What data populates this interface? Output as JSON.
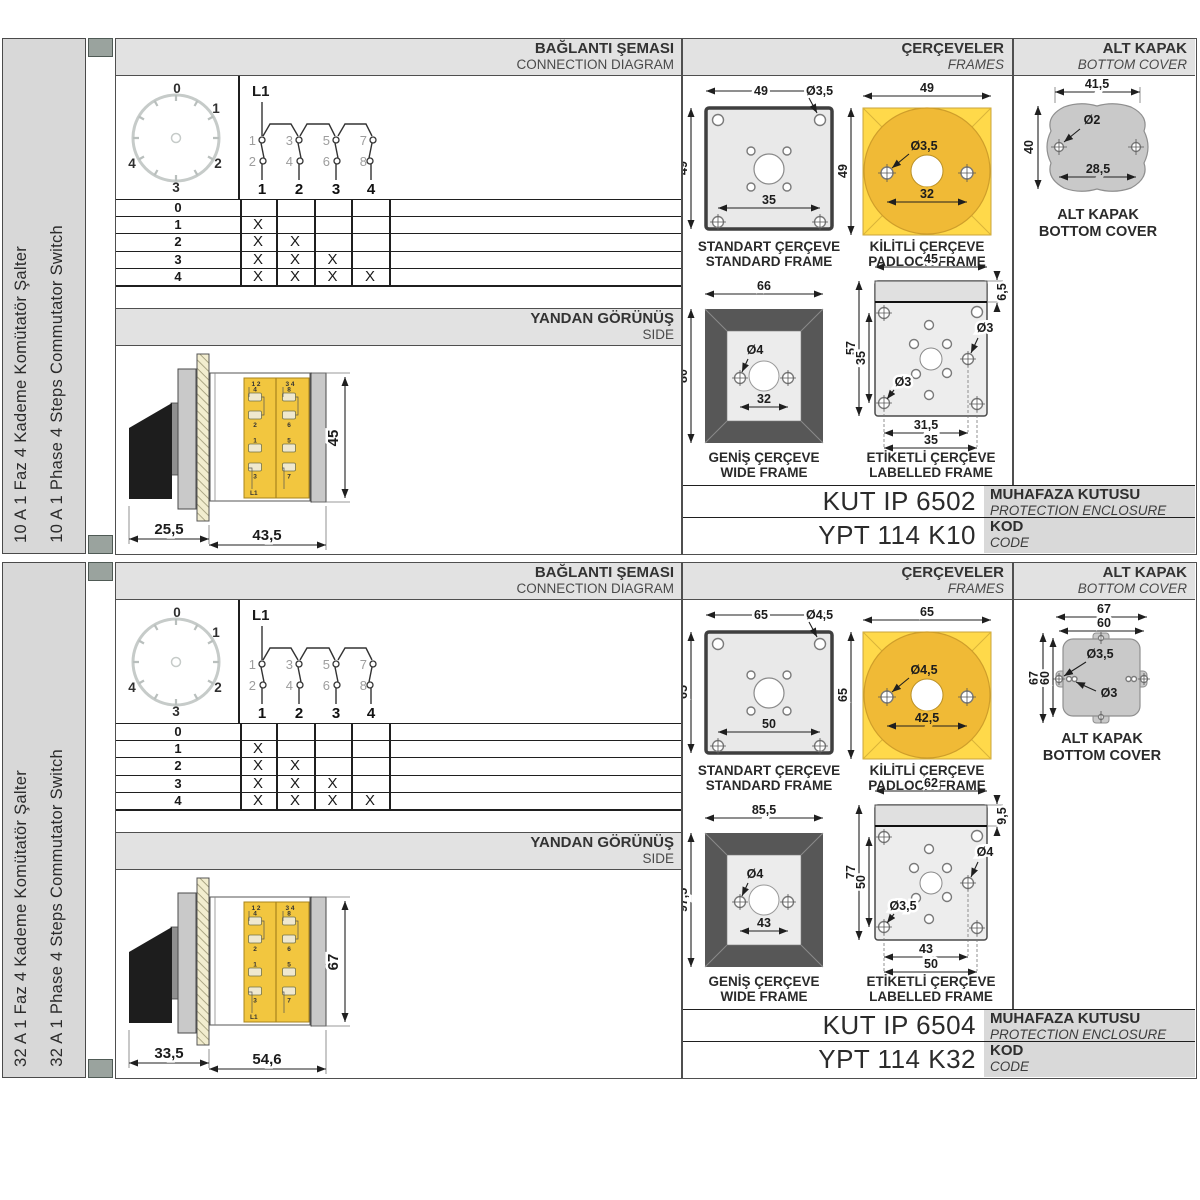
{
  "sections": [
    {
      "sidebar": {
        "title_tr": "10 A 1 Faz 4 Kademe Komütatör Şalter",
        "title_en": "10 A 1 Phase 4 Steps Commutator Switch"
      },
      "connection": {
        "header_tr": "BAĞLANTI ŞEMASI",
        "header_en": "CONNECTION DIAGRAM",
        "dial": {
          "labels": [
            "0",
            "1",
            "2",
            "3",
            "4"
          ]
        },
        "line_label": "L1",
        "contacts_top": [
          "1",
          "3",
          "5",
          "7"
        ],
        "contacts_bottom": [
          "2",
          "4",
          "6",
          "8"
        ],
        "terminals": [
          "1",
          "2",
          "3",
          "4"
        ],
        "table": {
          "rows": [
            {
              "label": "0",
              "cells": [
                "",
                "",
                "",
                ""
              ]
            },
            {
              "label": "1",
              "cells": [
                "X",
                "",
                "",
                ""
              ]
            },
            {
              "label": "2",
              "cells": [
                "X",
                "X",
                "",
                ""
              ]
            },
            {
              "label": "3",
              "cells": [
                "X",
                "X",
                "X",
                ""
              ]
            },
            {
              "label": "4",
              "cells": [
                "X",
                "X",
                "X",
                "X"
              ]
            }
          ]
        }
      },
      "side_view": {
        "header_tr": "YANDAN GÖRÜNÜŞ",
        "header_en": "SIDE",
        "dims": {
          "front": "25,5",
          "body": "43,5",
          "height": "45"
        },
        "block": {
          "pair1": "1 2",
          "pair2": "3 4",
          "col1": [
            "4",
            "2",
            "1",
            "3"
          ],
          "col2": [
            "8",
            "6",
            "5",
            "7"
          ],
          "feed": "L1"
        }
      },
      "frames": {
        "header_tr": "ÇERÇEVELER",
        "header_en": "FRAMES",
        "standard": {
          "label_tr": "STANDART ÇERÇEVE",
          "label_en": "STANDARD FRAME",
          "width": "49",
          "height": "49",
          "hole": "Ø3,5",
          "spacing": "35"
        },
        "padlock": {
          "label_tr": "KİLİTLİ ÇERÇEVE",
          "label_en": "PADLOCK FRAME",
          "width": "49",
          "height": "49",
          "hole": "Ø3,5",
          "spacing": "32"
        },
        "wide": {
          "label_tr": "GENİŞ ÇERÇEVE",
          "label_en": "WIDE FRAME",
          "width": "66",
          "height": "80",
          "hole": "Ø4",
          "spacing": "32"
        },
        "labelled": {
          "label_tr": "ETİKETLİ ÇERÇEVE",
          "label_en": "LABELLED FRAME",
          "width": "45",
          "strip": "6,5",
          "height": "57",
          "inner_height": "35",
          "hole_right": "Ø3",
          "hole_left": "Ø3",
          "spacing_inner": "31,5",
          "spacing_outer": "35"
        }
      },
      "bottom_cover": {
        "header_tr": "ALT KAPAK",
        "header_en": "BOTTOM COVER",
        "label_tr": "ALT KAPAK",
        "label_en": "BOTTOM COVER",
        "dims": {
          "width": "41,5",
          "height": "40",
          "hole": "Ø2",
          "spacing": "28,5"
        }
      },
      "codes": {
        "enclosure_code": "KUT IP 6502",
        "enclosure_tr": "MUHAFAZA KUTUSU",
        "enclosure_en": "PROTECTION ENCLOSURE",
        "product_code": "YPT 114 K10",
        "code_tr": "KOD",
        "code_en": "CODE"
      }
    },
    {
      "sidebar": {
        "title_tr": "32 A 1 Faz 4 Kademe Komütatör Şalter",
        "title_en": "32 A 1 Phase 4 Steps Commutator Switch"
      },
      "connection": {
        "header_tr": "BAĞLANTI ŞEMASI",
        "header_en": "CONNECTION DIAGRAM",
        "dial": {
          "labels": [
            "0",
            "1",
            "2",
            "3",
            "4"
          ]
        },
        "line_label": "L1",
        "contacts_top": [
          "1",
          "3",
          "5",
          "7"
        ],
        "contacts_bottom": [
          "2",
          "4",
          "6",
          "8"
        ],
        "terminals": [
          "1",
          "2",
          "3",
          "4"
        ],
        "table": {
          "rows": [
            {
              "label": "0",
              "cells": [
                "",
                "",
                "",
                ""
              ]
            },
            {
              "label": "1",
              "cells": [
                "X",
                "",
                "",
                ""
              ]
            },
            {
              "label": "2",
              "cells": [
                "X",
                "X",
                "",
                ""
              ]
            },
            {
              "label": "3",
              "cells": [
                "X",
                "X",
                "X",
                ""
              ]
            },
            {
              "label": "4",
              "cells": [
                "X",
                "X",
                "X",
                "X"
              ]
            }
          ]
        }
      },
      "side_view": {
        "header_tr": "YANDAN GÖRÜNÜŞ",
        "header_en": "SIDE",
        "dims": {
          "front": "33,5",
          "body": "54,6",
          "height": "67"
        },
        "block": {
          "pair1": "1 2",
          "pair2": "3 4",
          "col1": [
            "4",
            "2",
            "1",
            "3"
          ],
          "col2": [
            "8",
            "6",
            "5",
            "7"
          ],
          "feed": "L1"
        }
      },
      "frames": {
        "header_tr": "ÇERÇEVELER",
        "header_en": "FRAMES",
        "standard": {
          "label_tr": "STANDART ÇERÇEVE",
          "label_en": "STANDARD FRAME",
          "width": "65",
          "height": "65",
          "hole": "Ø4,5",
          "spacing": "50"
        },
        "padlock": {
          "label_tr": "KİLİTLİ ÇERÇEVE",
          "label_en": "PADLOCK FRAME",
          "width": "65",
          "height": "65",
          "hole": "Ø4,5",
          "spacing": "42,5"
        },
        "wide": {
          "label_tr": "GENİŞ ÇERÇEVE",
          "label_en": "WIDE FRAME",
          "width": "85,5",
          "height": "97,5",
          "hole": "Ø4",
          "spacing": "43"
        },
        "labelled": {
          "label_tr": "ETİKETLİ ÇERÇEVE",
          "label_en": "LABELLED FRAME",
          "width": "62",
          "strip": "9,5",
          "height": "77",
          "inner_height": "50",
          "hole_right": "Ø4",
          "hole_left": "Ø3,5",
          "spacing_inner": "43",
          "spacing_outer": "50"
        }
      },
      "bottom_cover": {
        "header_tr": "ALT KAPAK",
        "header_en": "BOTTOM COVER",
        "label_tr": "ALT KAPAK",
        "label_en": "BOTTOM COVER",
        "dims": {
          "outer_width": "67",
          "inner_width": "60",
          "outer_height": "67",
          "inner_height": "60",
          "hole_tab": "Ø3,5",
          "hole_inner": "Ø3"
        }
      },
      "codes": {
        "enclosure_code": "KUT IP 6504",
        "enclosure_tr": "MUHAFAZA KUTUSU",
        "enclosure_en": "PROTECTION ENCLOSURE",
        "product_code": "YPT 114 K32",
        "code_tr": "KOD",
        "code_en": "CODE"
      }
    }
  ]
}
